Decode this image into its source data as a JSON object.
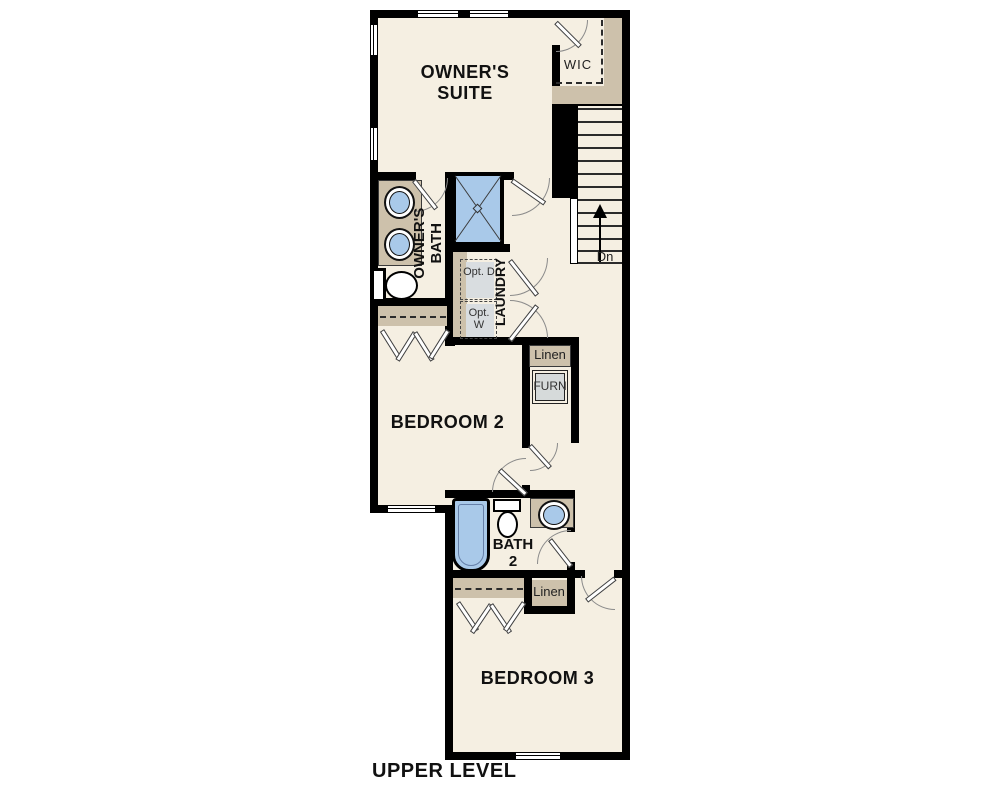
{
  "plan_title": "UPPER LEVEL",
  "labels": {
    "owners_suite": "OWNER'S SUITE",
    "wic": "WIC",
    "owners_bath": "OWNER'S BATH",
    "laundry": "LAUNDRY",
    "opt_dryer": "Opt. D",
    "opt_washer": "Opt. W",
    "linen_upper": "Linen",
    "furnace": "FURN",
    "bedroom_2": "BEDROOM 2",
    "bath_2": "BATH 2",
    "linen_lower": "Linen",
    "bedroom_3": "BEDROOM 3",
    "stairs_direction": "Dn"
  },
  "colors": {
    "floor": "#f5efe2",
    "casework_tan": "#cdc1ab",
    "fixture_blue": "#a9c9e9",
    "appliance_gray": "#d9dde0",
    "wall": "#000000"
  }
}
